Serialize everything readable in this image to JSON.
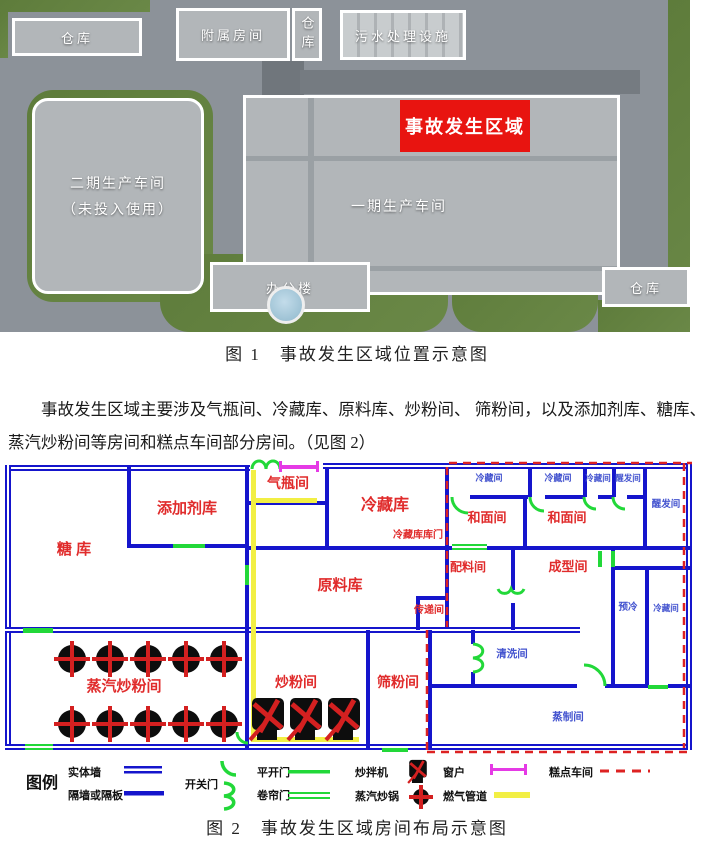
{
  "figure1": {
    "caption": "图 1　事故发生区域位置示意图",
    "badge_color": "#e81410",
    "labels": {
      "warehouse_tl": "仓库",
      "annex": "附属房间",
      "warehouse_top": "仓库",
      "sewage": "污水处理设施",
      "phase2_line1": "二期生产车间",
      "phase2_line2": "（未投入使用）",
      "phase1": "一期生产车间",
      "accident_badge": "事故发生区域",
      "office": "办公楼",
      "warehouse_br": "仓库"
    }
  },
  "paragraph": "事故发生区域主要涉及气瓶间、冷藏库、原料库、炒粉间、 筛粉间，以及添加剂库、糖库、蒸汽炒粉间等房间和糕点车间部分房间。（见图 2）",
  "figure2": {
    "caption": "图 2　事故发生区域房间布局示意图",
    "colors": {
      "wall": "#1515cc",
      "door": "#22d839",
      "window": "#e53ae5",
      "pipe": "#f2ef44",
      "boundary": "#dd2222",
      "label_red": "#e02b2b",
      "label_blue": "#4353cf",
      "equipment_black": "#0d0d0d",
      "equipment_red": "#d42020"
    },
    "rooms": [
      {
        "label": "糖 库",
        "x": 74,
        "y": 104,
        "c": "red",
        "s": 15
      },
      {
        "label": "添加剂库",
        "x": 187,
        "y": 63,
        "c": "red",
        "s": 15
      },
      {
        "label": "气瓶间",
        "x": 288,
        "y": 38,
        "c": "red",
        "s": 14
      },
      {
        "label": "冷藏库",
        "x": 385,
        "y": 60,
        "c": "red",
        "s": 16
      },
      {
        "label": "冷藏库库门",
        "x": 418,
        "y": 88,
        "c": "red",
        "s": 10
      },
      {
        "label": "原料库",
        "x": 340,
        "y": 140,
        "c": "red",
        "s": 15
      },
      {
        "label": "传递间",
        "x": 429,
        "y": 163,
        "c": "red",
        "s": 10
      },
      {
        "label": "配料间",
        "x": 468,
        "y": 121,
        "c": "red",
        "s": 12
      },
      {
        "label": "和面间",
        "x": 487,
        "y": 72,
        "c": "red",
        "s": 13
      },
      {
        "label": "和面间",
        "x": 567,
        "y": 72,
        "c": "red",
        "s": 13
      },
      {
        "label": "成型间",
        "x": 568,
        "y": 121,
        "c": "red",
        "s": 13
      },
      {
        "label": "蒸汽炒粉间",
        "x": 124,
        "y": 241,
        "c": "red",
        "s": 15
      },
      {
        "label": "炒粉间",
        "x": 296,
        "y": 237,
        "c": "red",
        "s": 14
      },
      {
        "label": "筛粉间",
        "x": 398,
        "y": 237,
        "c": "red",
        "s": 14
      },
      {
        "label": "冷藏间",
        "x": 489,
        "y": 31,
        "c": "blue",
        "s": 9
      },
      {
        "label": "冷藏间",
        "x": 558,
        "y": 31,
        "c": "blue",
        "s": 9
      },
      {
        "label": "冷藏间",
        "x": 598,
        "y": 31,
        "c": "blue",
        "s": 8.5
      },
      {
        "label": "醒发间",
        "x": 628,
        "y": 31,
        "c": "blue",
        "s": 8.5
      },
      {
        "label": "醒发间",
        "x": 666,
        "y": 57,
        "c": "blue",
        "s": 9.5
      },
      {
        "label": "预冷",
        "x": 628,
        "y": 160,
        "c": "blue",
        "s": 9.5
      },
      {
        "label": "冷藏间",
        "x": 666,
        "y": 161,
        "c": "blue",
        "s": 8.5
      },
      {
        "label": "清洗间",
        "x": 512,
        "y": 207,
        "c": "blue",
        "s": 10.5
      },
      {
        "label": "蒸制间",
        "x": 568,
        "y": 270,
        "c": "blue",
        "s": 10.5
      }
    ],
    "equipment": {
      "steam_pots": {
        "rows": [
          209,
          274
        ],
        "xs": [
          72,
          110,
          148,
          186,
          224
        ],
        "r": 14
      },
      "mixers": {
        "y": 270,
        "xs": [
          268,
          306,
          344
        ]
      }
    },
    "legend": {
      "title": "图例",
      "items": [
        {
          "label": "实体墙",
          "symbol": "solid-wall"
        },
        {
          "label": "隔墙或隔板",
          "symbol": "partition"
        },
        {
          "label": "开关门",
          "symbol": "swing-arc-door"
        },
        {
          "label": "平开门",
          "symbol": "single-door"
        },
        {
          "label": "卷帘门",
          "symbol": "roller-door"
        },
        {
          "label": "炒拌机",
          "symbol": "mixer"
        },
        {
          "label": "蒸汽炒锅",
          "symbol": "steam-pot"
        },
        {
          "label": "窗户",
          "symbol": "window"
        },
        {
          "label": "燃气管道",
          "symbol": "gas-pipe"
        },
        {
          "label": "糕点车间",
          "symbol": "pastry-boundary"
        }
      ]
    }
  }
}
